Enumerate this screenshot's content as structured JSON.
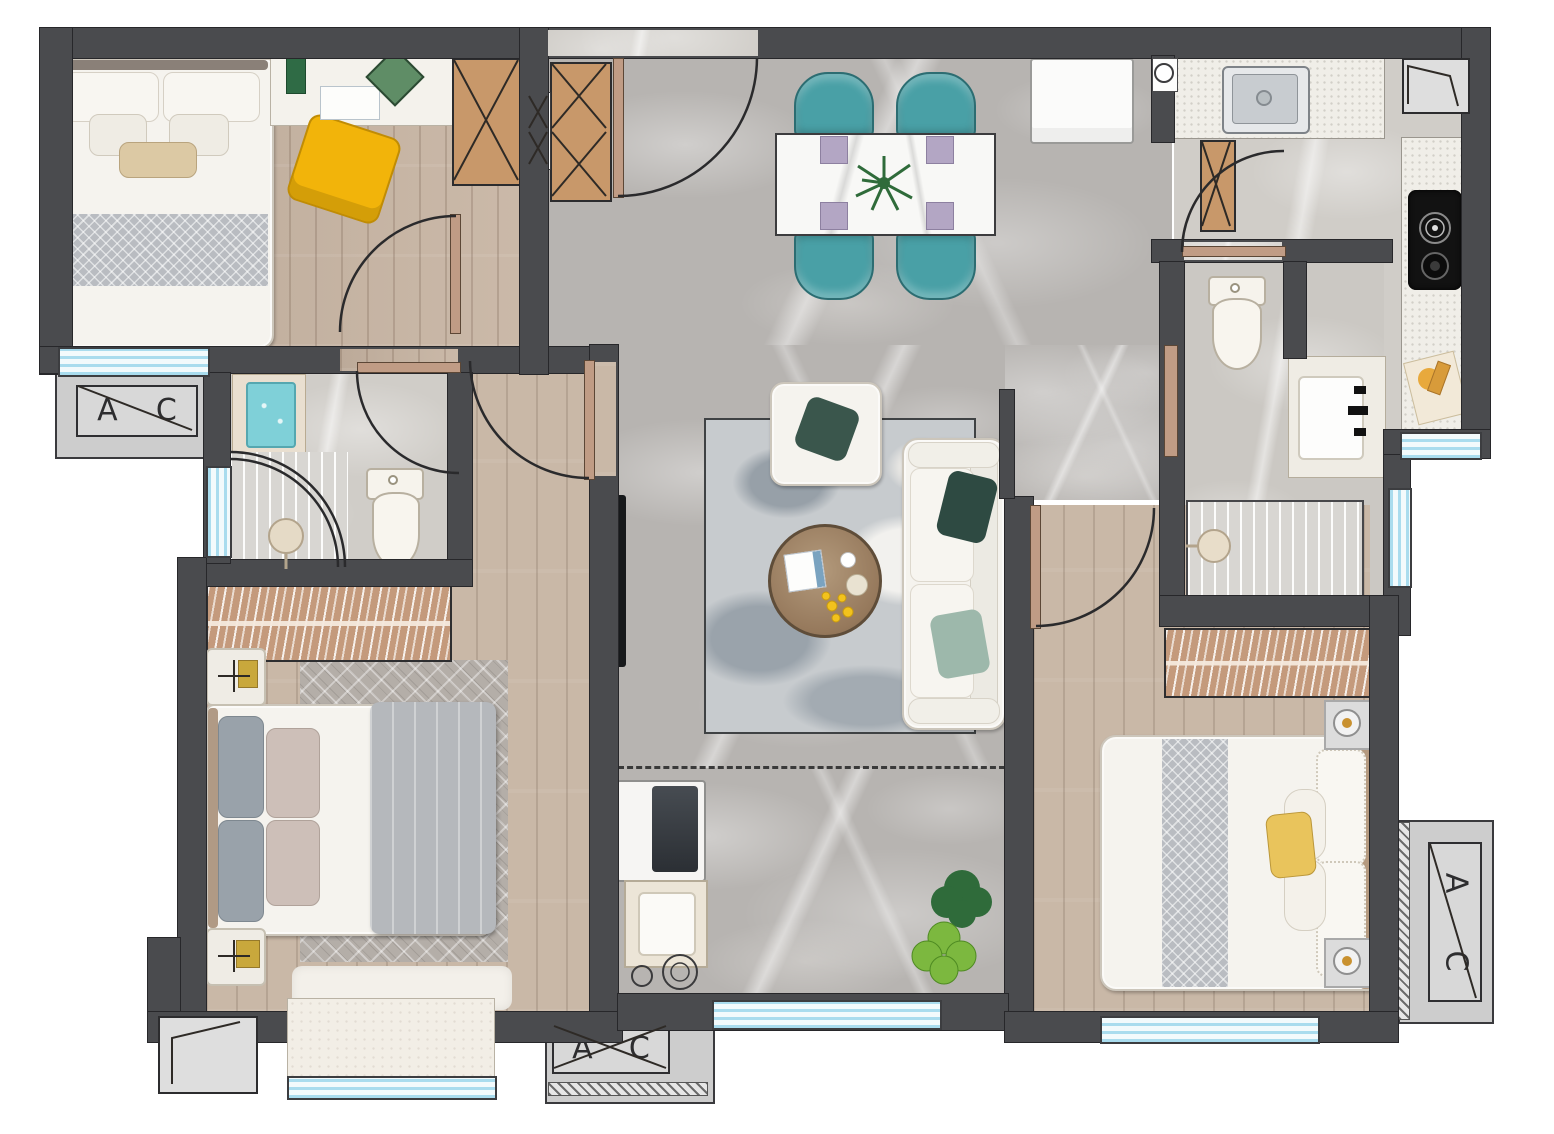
{
  "ac_units": [
    {
      "id": "left",
      "letter_a": "A",
      "letter_c": "C"
    },
    {
      "id": "balcony",
      "letter_a": "A",
      "letter_c": "C"
    },
    {
      "id": "bedroom2",
      "letter_a": "A",
      "letter_c": "C"
    }
  ],
  "palette": {
    "wall": "#4a4b4e",
    "wood_floor": "#c6b3a1",
    "marble_floor": "#b7b4b1",
    "kitchen_counter": "#f0eee8",
    "window_glass": "#a9dcee",
    "dining_chair_teal": "#49a0a6",
    "accent_yellow": "#f2b40a",
    "cabinet_wood": "#c8986a",
    "closet_wood": "#c49a7c",
    "white_furniture": "#f5f3ee",
    "living_rug": "#c7cbce",
    "blanket_gray": "#b5b8bc",
    "tv_black": "#17191b",
    "plant_dark": "#2f6b3a",
    "plant_light": "#7cb83f",
    "gold": "#c9a83c",
    "ac_platform": "#cdcdcd"
  }
}
